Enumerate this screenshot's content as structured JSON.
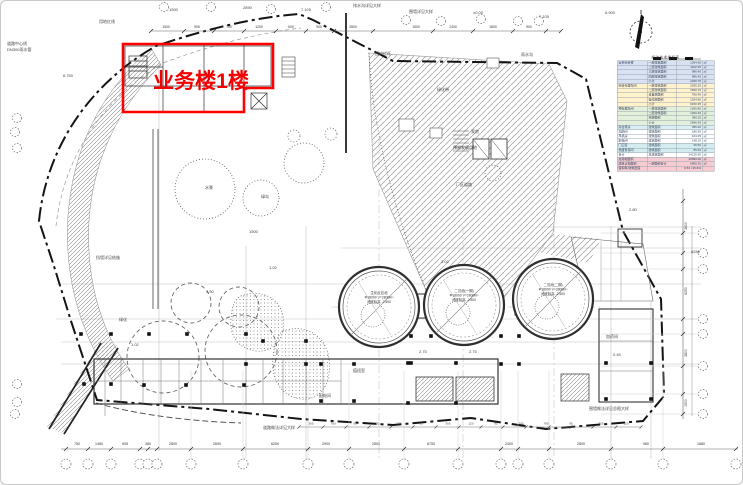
{
  "page": {
    "background": "#ffffff",
    "border": "#c9c9c9"
  },
  "highlight": {
    "label": "业务楼1楼",
    "color": "#ff0000"
  },
  "north_arrow": {
    "name": "north-compass"
  },
  "legend_table": {
    "title": "经济技术指标表",
    "band_colors": {
      "blue": "#d9e2f3",
      "yellow": "#fff2cc",
      "green": "#e2efda",
      "teal": "#daeef3",
      "cyan": "#d2ecf0",
      "pink": "#f6ccd2",
      "white": "#ffffff"
    },
    "rows": [
      {
        "band": "blue",
        "cells": [
          "业务综合楼",
          "一层建筑面积",
          "1264.60",
          "㎡"
        ]
      },
      {
        "band": "blue",
        "cells": [
          "",
          "二层建筑面积",
          "1102.35",
          "㎡"
        ]
      },
      {
        "band": "blue",
        "cells": [
          "",
          "三层建筑面积",
          "986.40",
          "㎡"
        ]
      },
      {
        "band": "blue",
        "cells": [
          "",
          "四层建筑面积",
          "986.40",
          "㎡"
        ]
      },
      {
        "band": "blue",
        "cells": [
          "",
          "小计",
          "4339.75",
          "㎡"
        ]
      },
      {
        "band": "yellow",
        "cells": [
          "综合处理车间",
          "一层建筑面积",
          "2035.20",
          "㎡"
        ]
      },
      {
        "band": "yellow",
        "cells": [
          "",
          "二层建筑面积",
          "1820.15",
          "㎡"
        ]
      },
      {
        "band": "yellow",
        "cells": [
          "",
          "设备层面积",
          "760.40",
          "㎡"
        ]
      },
      {
        "band": "yellow",
        "cells": [
          "",
          "操作层面积",
          "1534.60",
          "㎡"
        ]
      },
      {
        "band": "yellow",
        "cells": [
          "",
          "小计",
          "6150.35",
          "㎡"
        ]
      },
      {
        "band": "green",
        "cells": [
          "预处理车间",
          "一层建筑面积",
          "1265.80",
          "㎡"
        ]
      },
      {
        "band": "green",
        "cells": [
          "",
          "二层建筑面积",
          "1020.40",
          "㎡"
        ]
      },
      {
        "band": "green",
        "cells": [
          "",
          "夹层面积",
          "380.25",
          "㎡"
        ]
      },
      {
        "band": "green",
        "cells": [
          "",
          "小计",
          "2666.45",
          "㎡"
        ]
      },
      {
        "band": "teal",
        "cells": [
          "综合泵房",
          "建筑面积",
          "356.20",
          "㎡"
        ]
      },
      {
        "band": "white",
        "cells": [
          "加药间",
          "建筑面积",
          "186.50",
          "㎡"
        ]
      },
      {
        "band": "white",
        "cells": [
          "风机房",
          "建筑面积",
          "164.35",
          "㎡"
        ]
      },
      {
        "band": "white",
        "cells": [
          "配电间",
          "建筑面积",
          "148.20",
          "㎡"
        ]
      },
      {
        "band": "cyan",
        "cells": [
          "门卫室",
          "建筑面积",
          "36.50",
          "㎡"
        ]
      },
      {
        "band": "cyan",
        "cells": [
          "危废暂存间",
          "建筑面积",
          "85.60",
          "㎡"
        ]
      },
      {
        "band": "white",
        "cells": [
          "合计",
          "总建筑面积",
          "14135.90",
          "㎡"
        ]
      },
      {
        "band": "pink",
        "cells": [
          "总用地面积",
          "",
          "26890.00",
          "㎡"
        ]
      },
      {
        "band": "pink",
        "cells": [
          "建筑占地面积",
          "一层面积合计",
          "6890.35",
          "㎡"
        ]
      },
      {
        "band": "pink",
        "cells": [
          "容积率/建筑密度",
          "",
          "0.53 / 25.6%",
          ""
        ]
      }
    ]
  },
  "tanks": [
    {
      "cx": 378,
      "cy": 306,
      "r": 40,
      "lines": [
        "生化反应池",
        "Ф18000 V=2800m³",
        "池底标高 -2.500"
      ]
    },
    {
      "cx": 463,
      "cy": 304,
      "r": 40,
      "lines": [
        "二沉池(一期)",
        "Ф18000 V=2800m³",
        "池底标高 -2.500"
      ]
    },
    {
      "cx": 552,
      "cy": 298,
      "r": 40,
      "lines": [
        "二沉池(二期)",
        "Ф18000 V=2800m³",
        "池底标高 -2.500"
      ]
    }
  ],
  "bubbles": {
    "bottom_y": 463,
    "bottom_x": [
      65,
      87,
      110,
      139,
      147,
      156,
      190,
      242,
      307,
      348,
      403,
      457,
      500,
      517,
      548,
      610,
      662,
      735
    ],
    "top": [
      [
        163,
        6
      ],
      [
        210,
        6
      ],
      [
        270,
        8
      ],
      [
        325,
        6
      ],
      [
        405,
        19
      ],
      [
        440,
        20
      ],
      [
        480,
        18
      ],
      [
        517,
        20
      ],
      [
        538,
        20
      ]
    ],
    "right_x": 702,
    "right_y": [
      232,
      252,
      268,
      318,
      333,
      365,
      393,
      413
    ],
    "left": [
      [
        16,
        117
      ],
      [
        14,
        131
      ],
      [
        16,
        147
      ],
      [
        16,
        383
      ],
      [
        16,
        401
      ],
      [
        14,
        413
      ]
    ]
  },
  "column_dots": [
    [
      80,
      333
    ],
    [
      110,
      333
    ],
    [
      148,
      333
    ],
    [
      186,
      333
    ],
    [
      245,
      333
    ],
    [
      410,
      335
    ],
    [
      430,
      335
    ],
    [
      500,
      335
    ],
    [
      518,
      335
    ],
    [
      83,
      383
    ],
    [
      110,
      383
    ],
    [
      143,
      384
    ],
    [
      185,
      384
    ],
    [
      243,
      384
    ],
    [
      410,
      362
    ],
    [
      455,
      362
    ],
    [
      500,
      363
    ],
    [
      518,
      363
    ],
    [
      320,
      400
    ],
    [
      353,
      400
    ],
    [
      407,
      402
    ],
    [
      455,
      402
    ],
    [
      353,
      363
    ],
    [
      407,
      362
    ],
    [
      605,
      362
    ],
    [
      650,
      362
    ],
    [
      605,
      398
    ],
    [
      650,
      398
    ],
    [
      245,
      363
    ],
    [
      305,
      363
    ],
    [
      320,
      363
    ],
    [
      262,
      340
    ],
    [
      305,
      340
    ]
  ],
  "dimensions": {
    "bottom": [
      {
        "x": 76,
        "v": "750"
      },
      {
        "x": 98,
        "v": "1480"
      },
      {
        "x": 124,
        "v": "905"
      },
      {
        "x": 147,
        "v": "380"
      },
      {
        "x": 172,
        "v": "2800"
      },
      {
        "x": 216,
        "v": "2690"
      },
      {
        "x": 274,
        "v": "6250"
      },
      {
        "x": 325,
        "v": "2900"
      },
      {
        "x": 375,
        "v": "2800"
      },
      {
        "x": 430,
        "v": "6750"
      },
      {
        "x": 508,
        "v": "2400"
      },
      {
        "x": 580,
        "v": "2800"
      },
      {
        "x": 645,
        "v": "960"
      },
      {
        "x": 700,
        "v": "1880"
      }
    ],
    "bottom2": [
      {
        "x": 310,
        "v": "305"
      },
      {
        "x": 332,
        "v": "780"
      },
      {
        "x": 354,
        "v": "95"
      },
      {
        "x": 376,
        "v": "305"
      },
      {
        "x": 398,
        "v": "120"
      },
      {
        "x": 420,
        "v": "95"
      },
      {
        "x": 447,
        "v": "305"
      },
      {
        "x": 470,
        "v": "120"
      },
      {
        "x": 495,
        "v": "95"
      },
      {
        "x": 520,
        "v": "305"
      },
      {
        "x": 545,
        "v": "780"
      },
      {
        "x": 570,
        "v": "95"
      },
      {
        "x": 600,
        "v": "305"
      },
      {
        "x": 625,
        "v": "120"
      }
    ],
    "top": [
      {
        "x": 165,
        "v": "1500"
      },
      {
        "x": 196,
        "v": "905"
      },
      {
        "x": 228,
        "v": "750"
      },
      {
        "x": 258,
        "v": "1200"
      },
      {
        "x": 290,
        "v": "600"
      },
      {
        "x": 318,
        "v": "900"
      },
      {
        "x": 352,
        "v": "2800"
      },
      {
        "x": 415,
        "v": "1500"
      },
      {
        "x": 452,
        "v": "2400"
      },
      {
        "x": 492,
        "v": "1800"
      },
      {
        "x": 528,
        "v": "900"
      }
    ],
    "right": [
      {
        "y": 225,
        "v": "2800"
      },
      {
        "y": 290,
        "v": "6250"
      },
      {
        "y": 352,
        "v": "2800"
      },
      {
        "y": 402,
        "v": "1500"
      }
    ],
    "top_tick_x": [
      150,
      183,
      213,
      243,
      275,
      305,
      333,
      372,
      432,
      472,
      512,
      545,
      560
    ],
    "bottom2_tick_x": [
      298,
      322,
      345,
      368,
      390,
      412,
      435,
      458,
      480,
      502,
      525,
      548,
      570,
      592,
      615,
      640
    ],
    "right_tick_y": [
      200,
      232,
      252,
      268,
      318,
      333,
      365,
      393,
      413
    ]
  },
  "annotations": [
    {
      "x": 6,
      "y": 44,
      "t": "道路中心线"
    },
    {
      "x": 6,
      "y": 50,
      "t": "DN300雨水管"
    },
    {
      "x": 62,
      "y": 76,
      "t": "6.750"
    },
    {
      "x": 98,
      "y": 22,
      "t": "用地红线"
    },
    {
      "x": 168,
      "y": 10,
      "t": "1500"
    },
    {
      "x": 242,
      "y": 8,
      "t": "2890"
    },
    {
      "x": 300,
      "y": 10,
      "t": "7.105"
    },
    {
      "x": 352,
      "y": 6,
      "t": "排水沟详见大样"
    },
    {
      "x": 408,
      "y": 12,
      "t": "围墙详见大样"
    },
    {
      "x": 472,
      "y": 13,
      "t": "±0.00"
    },
    {
      "x": 538,
      "y": 17,
      "t": "7.105"
    },
    {
      "x": 604,
      "y": 13,
      "t": "6.900"
    },
    {
      "x": 436,
      "y": 90,
      "t": "绿化带"
    },
    {
      "x": 452,
      "y": 148,
      "t": "预留发展用地"
    },
    {
      "x": 470,
      "y": 132,
      "t": "泵房"
    },
    {
      "x": 455,
      "y": 185,
      "t": "厂区道路"
    },
    {
      "x": 440,
      "y": 262,
      "t": "3.02"
    },
    {
      "x": 268,
      "y": 268,
      "t": "1.02"
    },
    {
      "x": 205,
      "y": 292,
      "t": "4.50"
    },
    {
      "x": 118,
      "y": 320,
      "t": "绿化"
    },
    {
      "x": 95,
      "y": 258,
      "t": "挡墙详见结施"
    },
    {
      "x": 605,
      "y": 337,
      "t": "加药间"
    },
    {
      "x": 612,
      "y": 355,
      "t": "0.45"
    },
    {
      "x": 588,
      "y": 409,
      "t": "围墙做法详见总图大样"
    },
    {
      "x": 262,
      "y": 428,
      "t": "道路做法详见大样"
    },
    {
      "x": 130,
      "y": 345,
      "t": "1.02"
    },
    {
      "x": 318,
      "y": 396,
      "t": "配电间"
    },
    {
      "x": 352,
      "y": 371,
      "t": "值班室"
    },
    {
      "x": 690,
      "y": 252,
      "t": "6250"
    },
    {
      "x": 668,
      "y": 160,
      "t": "用地红线"
    },
    {
      "x": 520,
      "y": 55,
      "t": "雨水沟"
    },
    {
      "x": 374,
      "y": 54,
      "t": "围护栏杆"
    },
    {
      "x": 628,
      "y": 210,
      "t": "2.80"
    },
    {
      "x": 418,
      "y": 352,
      "t": "2.75"
    },
    {
      "x": 468,
      "y": 352,
      "t": "2.75"
    },
    {
      "x": 248,
      "y": 232,
      "t": "1500"
    },
    {
      "x": 204,
      "y": 188,
      "t": "水景"
    },
    {
      "x": 260,
      "y": 197,
      "t": "绿岛"
    }
  ]
}
